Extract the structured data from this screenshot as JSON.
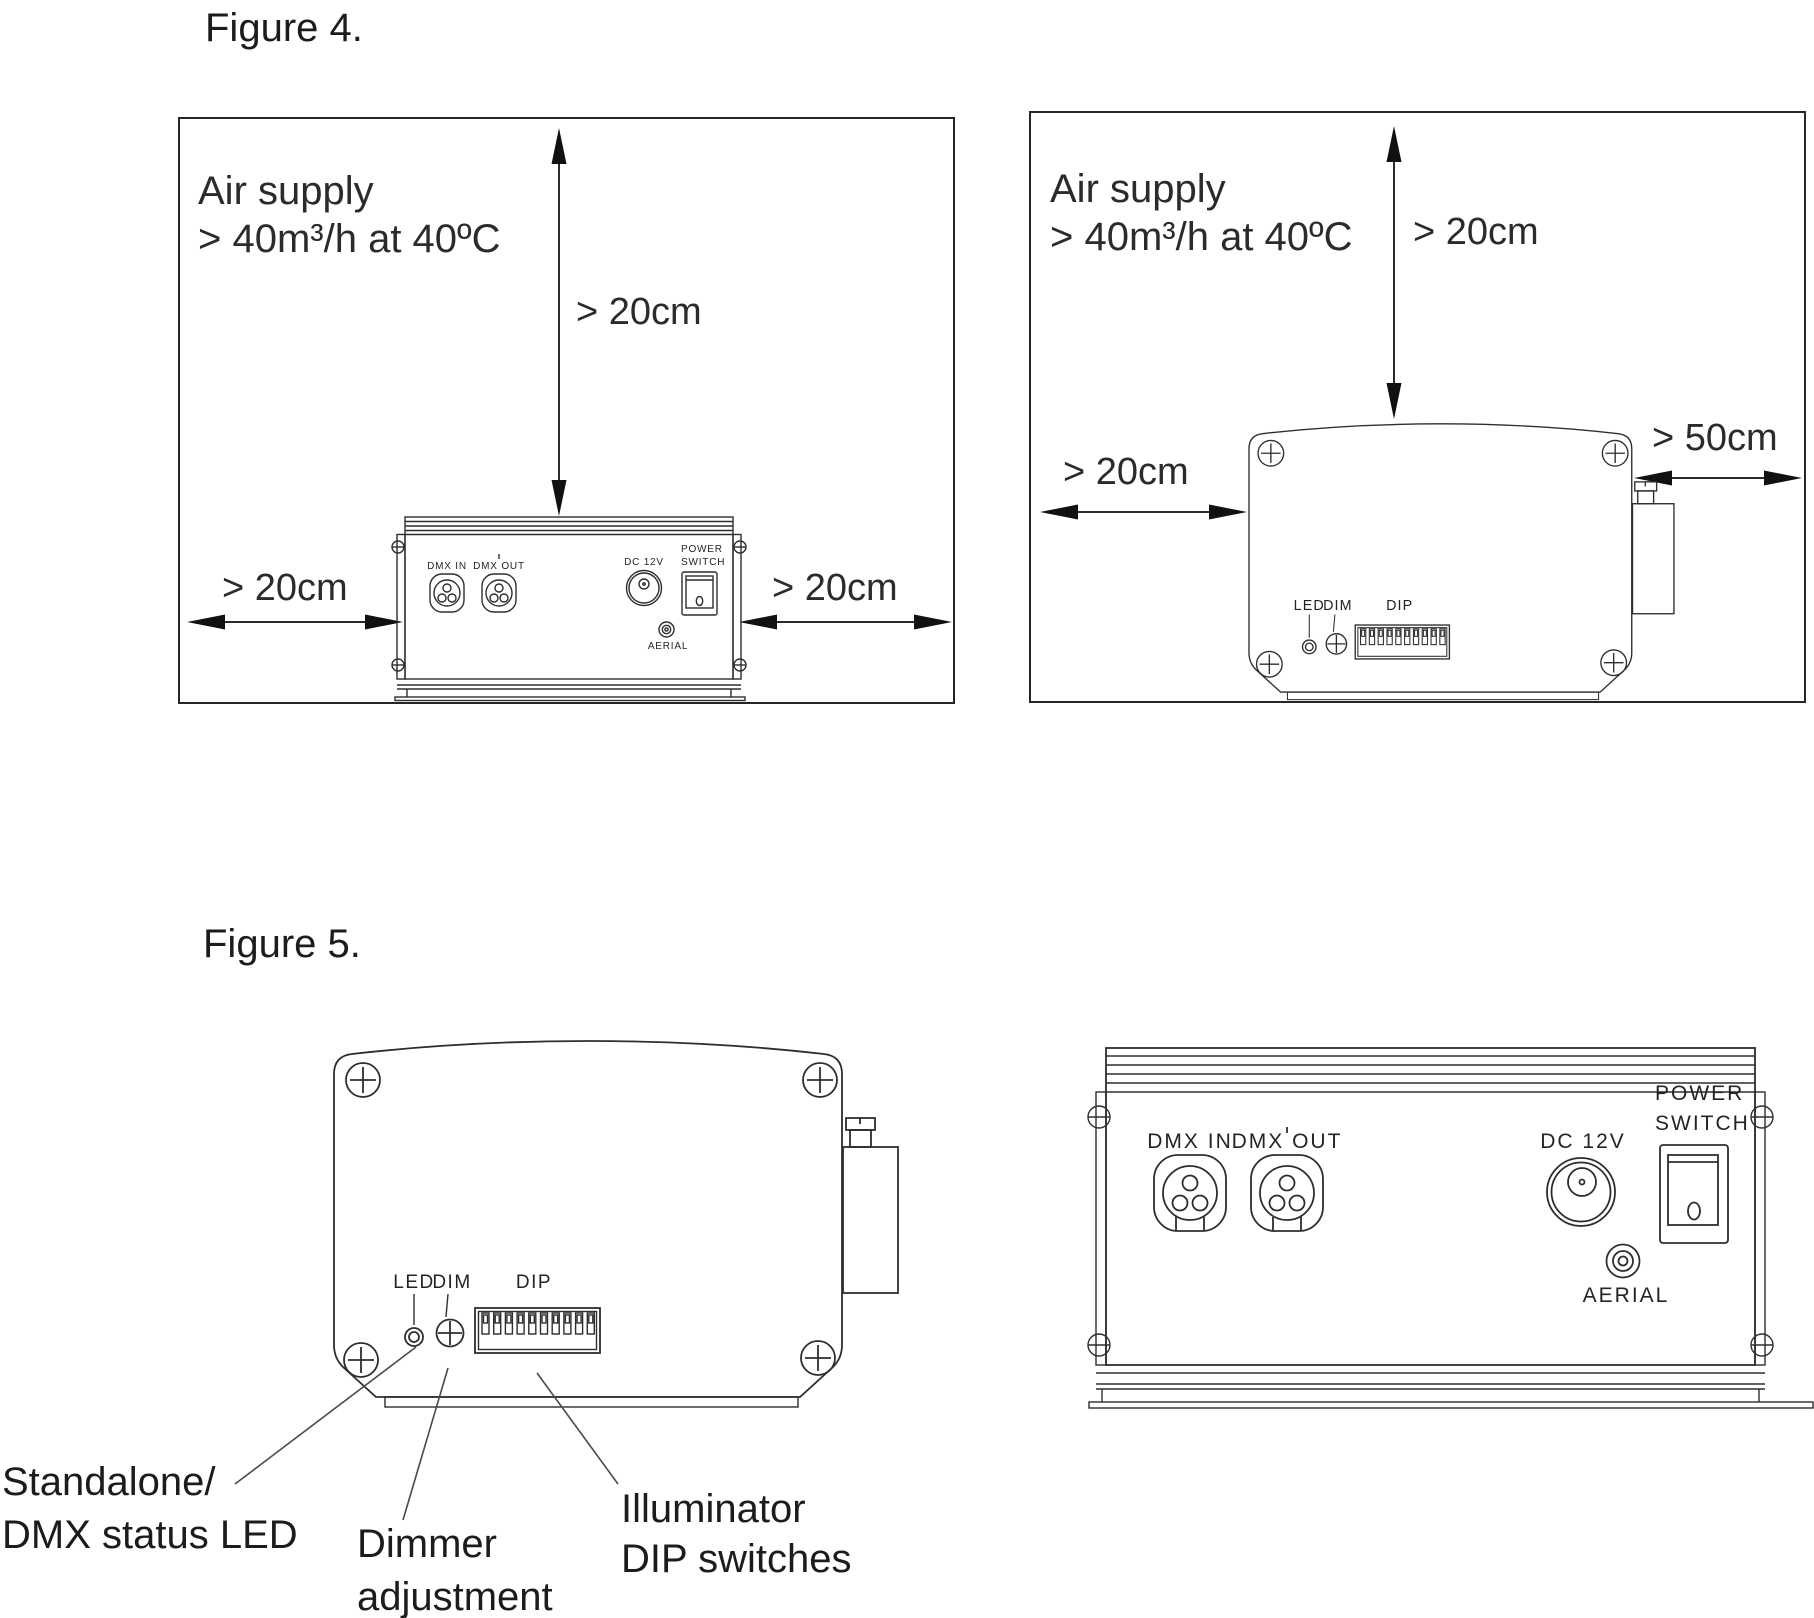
{
  "figure4": {
    "title": "Figure 4.",
    "left_panel": {
      "air_line1": "Air supply",
      "air_line2": "> 40m³/h at 40ºC",
      "clearance_top": "> 20cm",
      "clearance_left": "> 20cm",
      "clearance_right": "> 20cm"
    },
    "right_panel": {
      "air_line1": "Air supply",
      "air_line2": "> 40m³/h at 40ºC",
      "clearance_top": "> 20cm",
      "clearance_left": "> 20cm",
      "clearance_side": "> 50cm"
    }
  },
  "figure5": {
    "title": "Figure 5.",
    "callouts": {
      "led_line1": "Standalone/",
      "led_line2": "DMX status LED",
      "dimmer_line1": "Dimmer",
      "dimmer_line2": "adjustment",
      "dip_line1": "Illuminator",
      "dip_line2": "DIP switches"
    }
  },
  "front_panel": {
    "dmx_in": "DMX IN",
    "dmx_out": "DMX OUT",
    "dc12v": "DC 12V",
    "power_line1": "POWER",
    "power_line2": "SWITCH",
    "aerial": "AERIAL"
  },
  "back_panel": {
    "led": "LED",
    "dim": "DIM",
    "dip": "DIP"
  }
}
